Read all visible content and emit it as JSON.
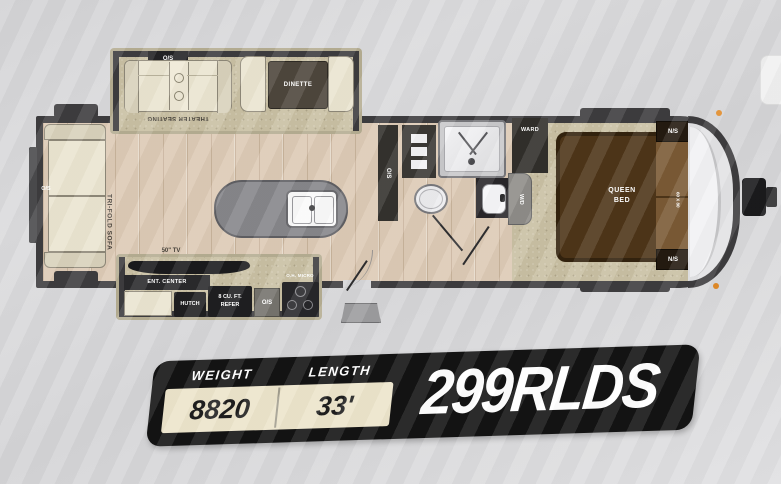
{
  "badge": {
    "weight_label": "WEIGHT",
    "weight_value": "8820",
    "length_label": "LENGTH",
    "length_value": "33'",
    "model": "299RLDS"
  },
  "labels": {
    "os": "O/S",
    "ns": "N/S",
    "theater_seating": "THEATER SEATING",
    "dinette": "DINETTE",
    "tri_fold_sofa": "TRI-FOLD SOFA",
    "tv": "50\" TV",
    "ent_center": "ENT. CENTER",
    "hutch": "HUTCH",
    "refer_line1": "8 CU. FT.",
    "refer_line2": "REFER",
    "micro": "O.H. MICRO",
    "ward": "WARD",
    "wd": "W/D",
    "queen_line1": "QUEEN",
    "queen_line2": "BED",
    "bed_size": "60 X 80"
  },
  "colors": {
    "wall": "#3d3c3e",
    "wood_floor": "#dccab5",
    "carpet": "#c9c0a3",
    "slide_trim": "#b5ad92",
    "bed_brown": "#4e3518",
    "badge_black": "#131313",
    "badge_cream": "#ece4cb",
    "clearance_light": "#e08a28"
  }
}
